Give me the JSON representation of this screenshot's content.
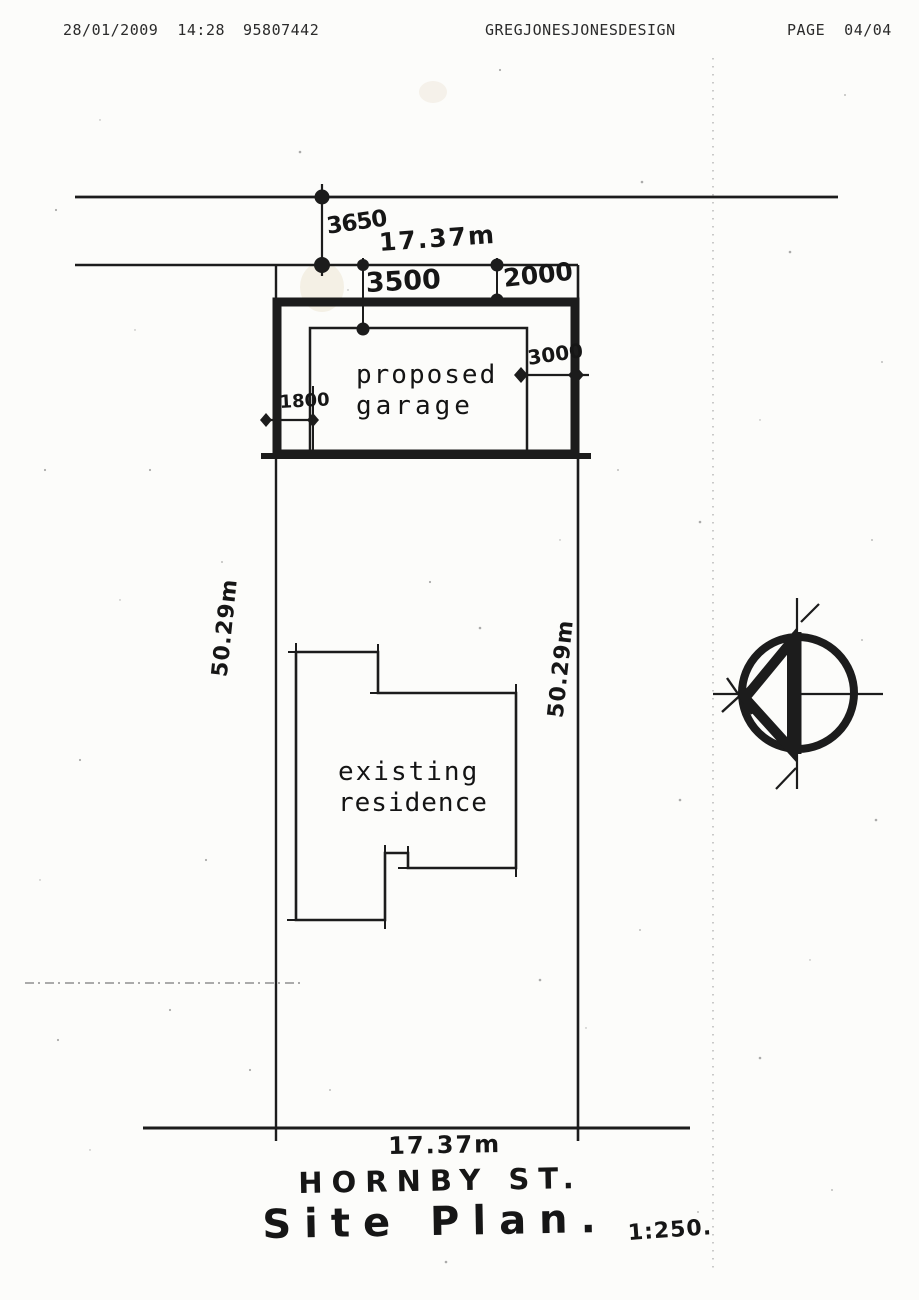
{
  "fax_header": {
    "datetime": "28/01/2009  14:28",
    "fax_number": "95807442",
    "sender": "GREGJONESJONESDESIGN",
    "page": "PAGE  04/04"
  },
  "plan": {
    "garage_label_line1": "proposed",
    "garage_label_line2": "garage",
    "residence_label_line1": "existing",
    "residence_label_line2": "residence",
    "street_name": "HORNBY ST.",
    "title": "Site Plan.",
    "scale": "1:250.",
    "north_icon": "north-arrow",
    "dims": {
      "top_offset": "3650",
      "top_frontage": "17.37m",
      "garage_seg_left": "3500",
      "garage_seg_right": "2000",
      "garage_depth": "3000",
      "garage_side_setback": "1800",
      "left_boundary": "50.29m",
      "right_boundary": "50.29m",
      "bottom_frontage": "17.37m"
    }
  },
  "colors": {
    "ink": "#1c1c1c",
    "paper": "#fcfcfa"
  }
}
